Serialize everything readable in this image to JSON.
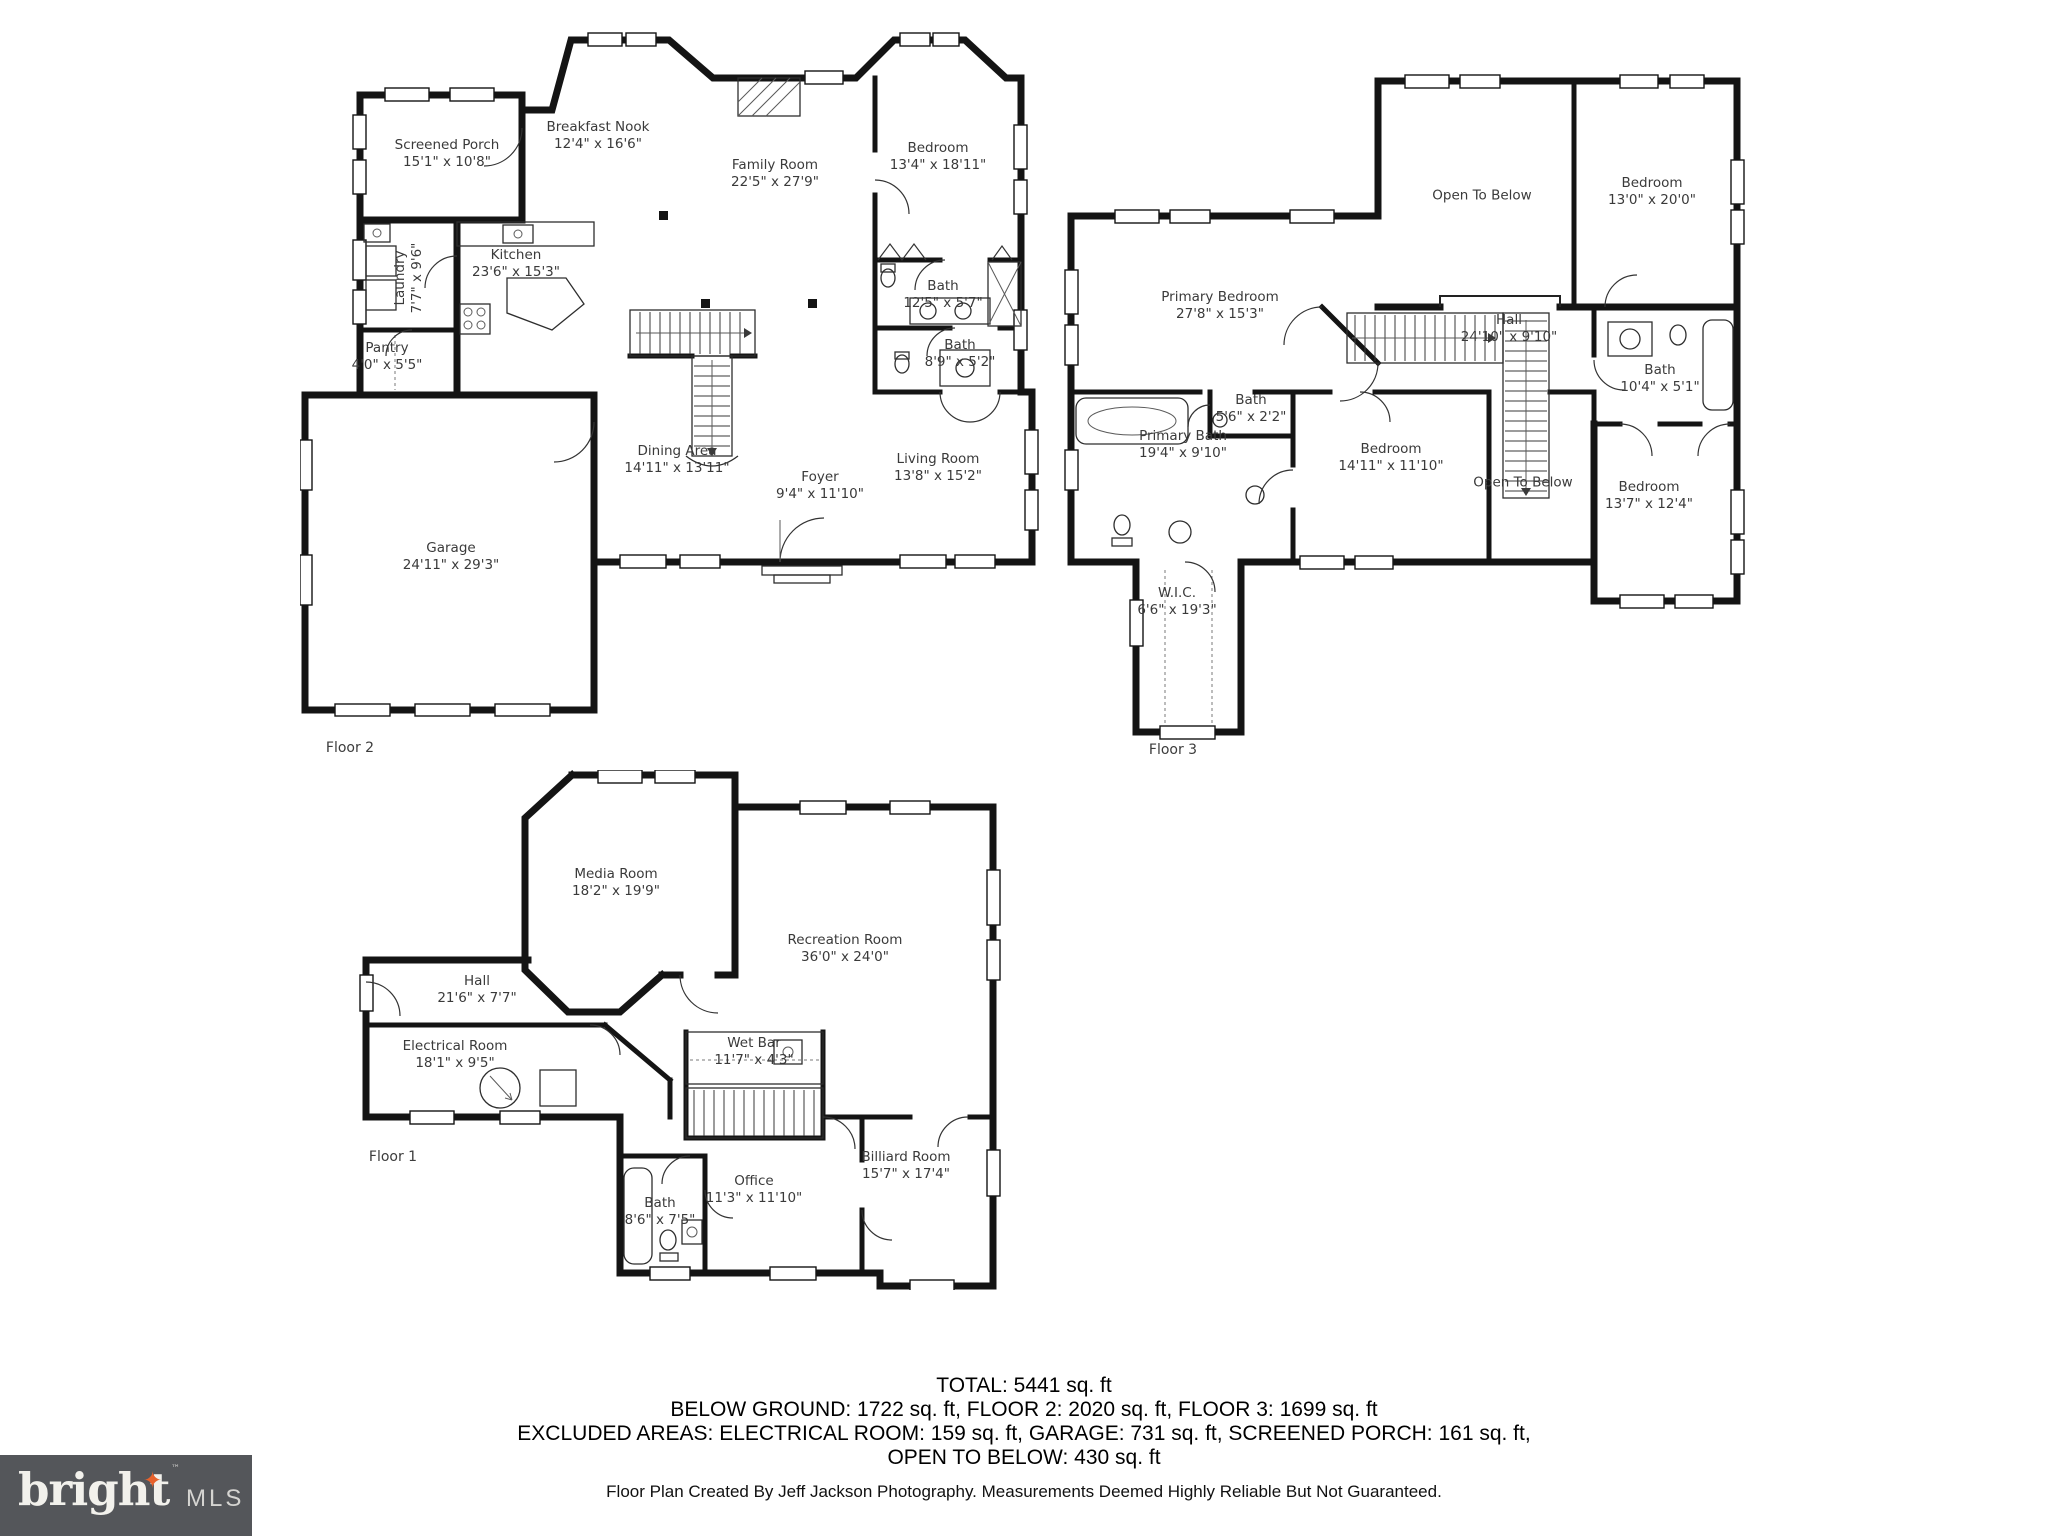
{
  "floors": {
    "floor2": {
      "caption": "Floor 2",
      "rooms": [
        {
          "name": "Screened Porch",
          "dims": "15'1\" x 10'8\""
        },
        {
          "name": "Breakfast Nook",
          "dims": "12'4\" x 16'6\""
        },
        {
          "name": "Family Room",
          "dims": "22'5\" x 27'9\""
        },
        {
          "name": "Bedroom",
          "dims": "13'4\" x 18'11\""
        },
        {
          "name": "Laundry",
          "dims": "7'7\" x 9'6\""
        },
        {
          "name": "Kitchen",
          "dims": "23'6\" x 15'3\""
        },
        {
          "name": "Bath",
          "dims": "12'5\" x 5'7\""
        },
        {
          "name": "Bath",
          "dims": "8'9\" x 5'2\""
        },
        {
          "name": "Pantry",
          "dims": "4'0\" x 5'5\""
        },
        {
          "name": "Dining Area",
          "dims": "14'11\" x 13'11\""
        },
        {
          "name": "Foyer",
          "dims": "9'4\" x 11'10\""
        },
        {
          "name": "Living Room",
          "dims": "13'8\" x 15'2\""
        },
        {
          "name": "Garage",
          "dims": "24'11\" x 29'3\""
        }
      ]
    },
    "floor3": {
      "caption": "Floor 3",
      "rooms": [
        {
          "name": "Open To Below",
          "dims": ""
        },
        {
          "name": "Bedroom",
          "dims": "13'0\" x 20'0\""
        },
        {
          "name": "Primary Bedroom",
          "dims": "27'8\" x 15'3\""
        },
        {
          "name": "Hall",
          "dims": "24'10\" x 9'10\""
        },
        {
          "name": "Bath",
          "dims": "10'4\" x 5'1\""
        },
        {
          "name": "Primary Bath",
          "dims": "19'4\" x 9'10\""
        },
        {
          "name": "Bath",
          "dims": "5'6\" x 2'2\""
        },
        {
          "name": "Bedroom",
          "dims": "14'11\" x 11'10\""
        },
        {
          "name": "Open To Below",
          "dims": ""
        },
        {
          "name": "Bedroom",
          "dims": "13'7\" x 12'4\""
        },
        {
          "name": "W.I.C.",
          "dims": "6'6\" x 19'3\""
        }
      ]
    },
    "floor1": {
      "caption": "Floor 1",
      "rooms": [
        {
          "name": "Media Room",
          "dims": "18'2\" x 19'9\""
        },
        {
          "name": "Recreation Room",
          "dims": "36'0\" x 24'0\""
        },
        {
          "name": "Hall",
          "dims": "21'6\" x 7'7\""
        },
        {
          "name": "Electrical Room",
          "dims": "18'1\" x 9'5\""
        },
        {
          "name": "Wet Bar",
          "dims": "11'7\" x 4'3\""
        },
        {
          "name": "Billiard Room",
          "dims": "15'7\" x 17'4\""
        },
        {
          "name": "Office",
          "dims": "11'3\" x 11'10\""
        },
        {
          "name": "Bath",
          "dims": "8'6\" x 7'5\""
        }
      ]
    }
  },
  "summary": {
    "line1": "TOTAL: 5441 sq. ft",
    "line2": "BELOW GROUND: 1722 sq. ft, FLOOR 2: 2020 sq. ft, FLOOR 3: 1699 sq. ft",
    "line3": "EXCLUDED AREAS: ELECTRICAL ROOM: 159 sq. ft, GARAGE: 731 sq. ft, SCREENED PORCH: 161 sq. ft,",
    "line4": "OPEN TO BELOW: 430 sq. ft",
    "credit": "Floor Plan Created By Jeff Jackson Photography. Measurements Deemed Highly Reliable But Not Guaranteed."
  },
  "logo": {
    "brand": "bright",
    "suffix": "MLS",
    "tm": "™",
    "star": "✦",
    "box_color": "#54565a",
    "star_color": "#e8622c"
  }
}
